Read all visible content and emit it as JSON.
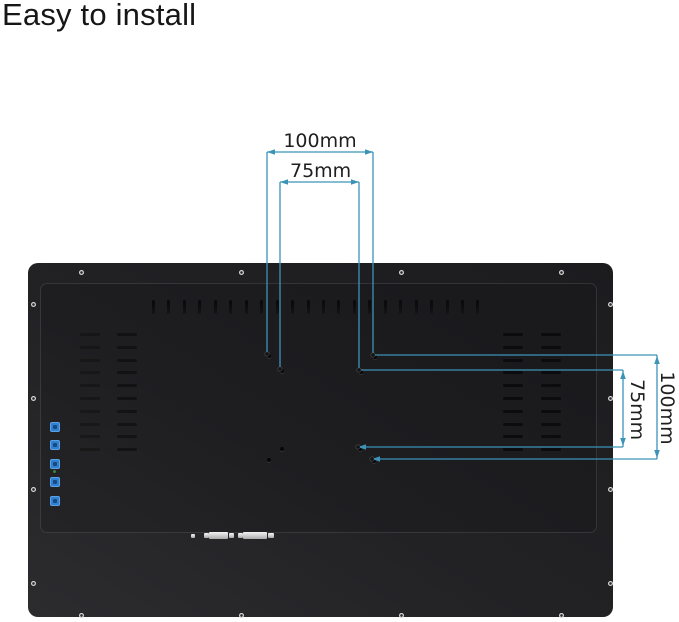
{
  "title": "Easy to install",
  "dimensions": {
    "top_outer": "100mm",
    "top_inner": "75mm",
    "right_inner": "75mm",
    "right_outer": "100mm"
  },
  "colors": {
    "background": "#ffffff",
    "dimension_line": "#3b93b8",
    "panel": "#212124",
    "button_blue": "#2f7fd2"
  },
  "monitor": {
    "top_vent_count": 22,
    "side_vent_rows": 10,
    "side_button_count": 5,
    "screw_count": 16,
    "vesa_hole_count": 8,
    "connector_count": 7
  }
}
